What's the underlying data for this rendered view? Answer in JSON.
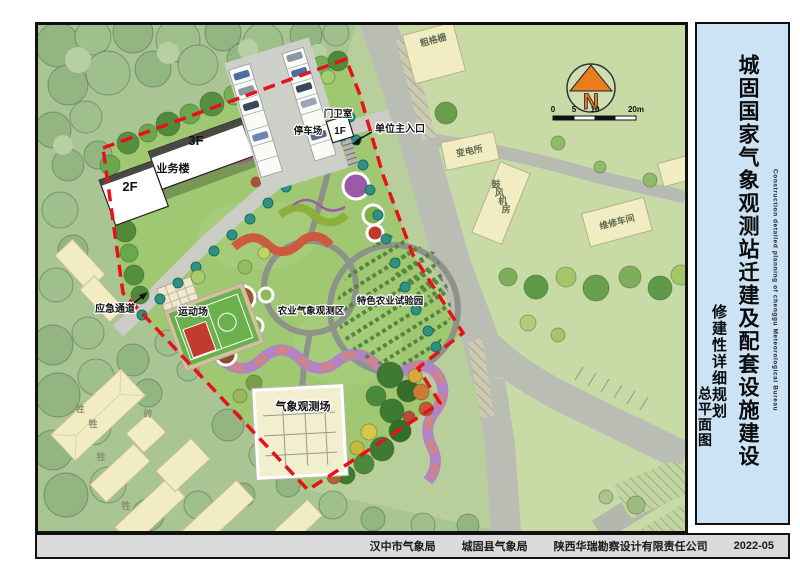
{
  "titleblock": {
    "main_title": "城固国家气象观测站迁建及配套设施建设",
    "subtitle_en": "Construction detailed planning of chenggu Meteorological Bureau",
    "plan_type": "修建性详细规划",
    "drawing_name": "总平面图"
  },
  "footer": {
    "org_city": "汉中市气象局",
    "org_county": "城固县气象局",
    "org_design": "陕西华瑞勘察设计有限责任公司",
    "date": "2022-05"
  },
  "map": {
    "north": "N",
    "scale_ticks": [
      "0",
      "5",
      "10",
      "20m"
    ],
    "labels": {
      "business_building": "业务楼",
      "floor_3f": "3F",
      "floor_2f": "2F",
      "floor_1f": "1F",
      "parking": "停车场",
      "guard_room": "门卫室",
      "main_entrance": "单位主入口",
      "coarse_screen": "粗格栅",
      "substation": "变电所",
      "blower_room": "鼓风机房",
      "maintenance_workshop": "维修车间",
      "emergency_passage": "应急通道",
      "sports_ground": "运动场",
      "agri_met_zone": "农业气象观测区",
      "agri_trial_garden": "特色农业试验园",
      "met_observation_field": "气象观测场",
      "livestock": "牲",
      "brick": "砖"
    }
  },
  "colors": {
    "site_boundary": "#e8101a",
    "lawn": "#a0c873",
    "woods": "#a8c593",
    "outside_green": "#c8daa6",
    "road": "#babdb4",
    "north_arrow": "#e87c1e",
    "panel_bg": "#cbe3f5",
    "footer_bg": "#dadada"
  }
}
